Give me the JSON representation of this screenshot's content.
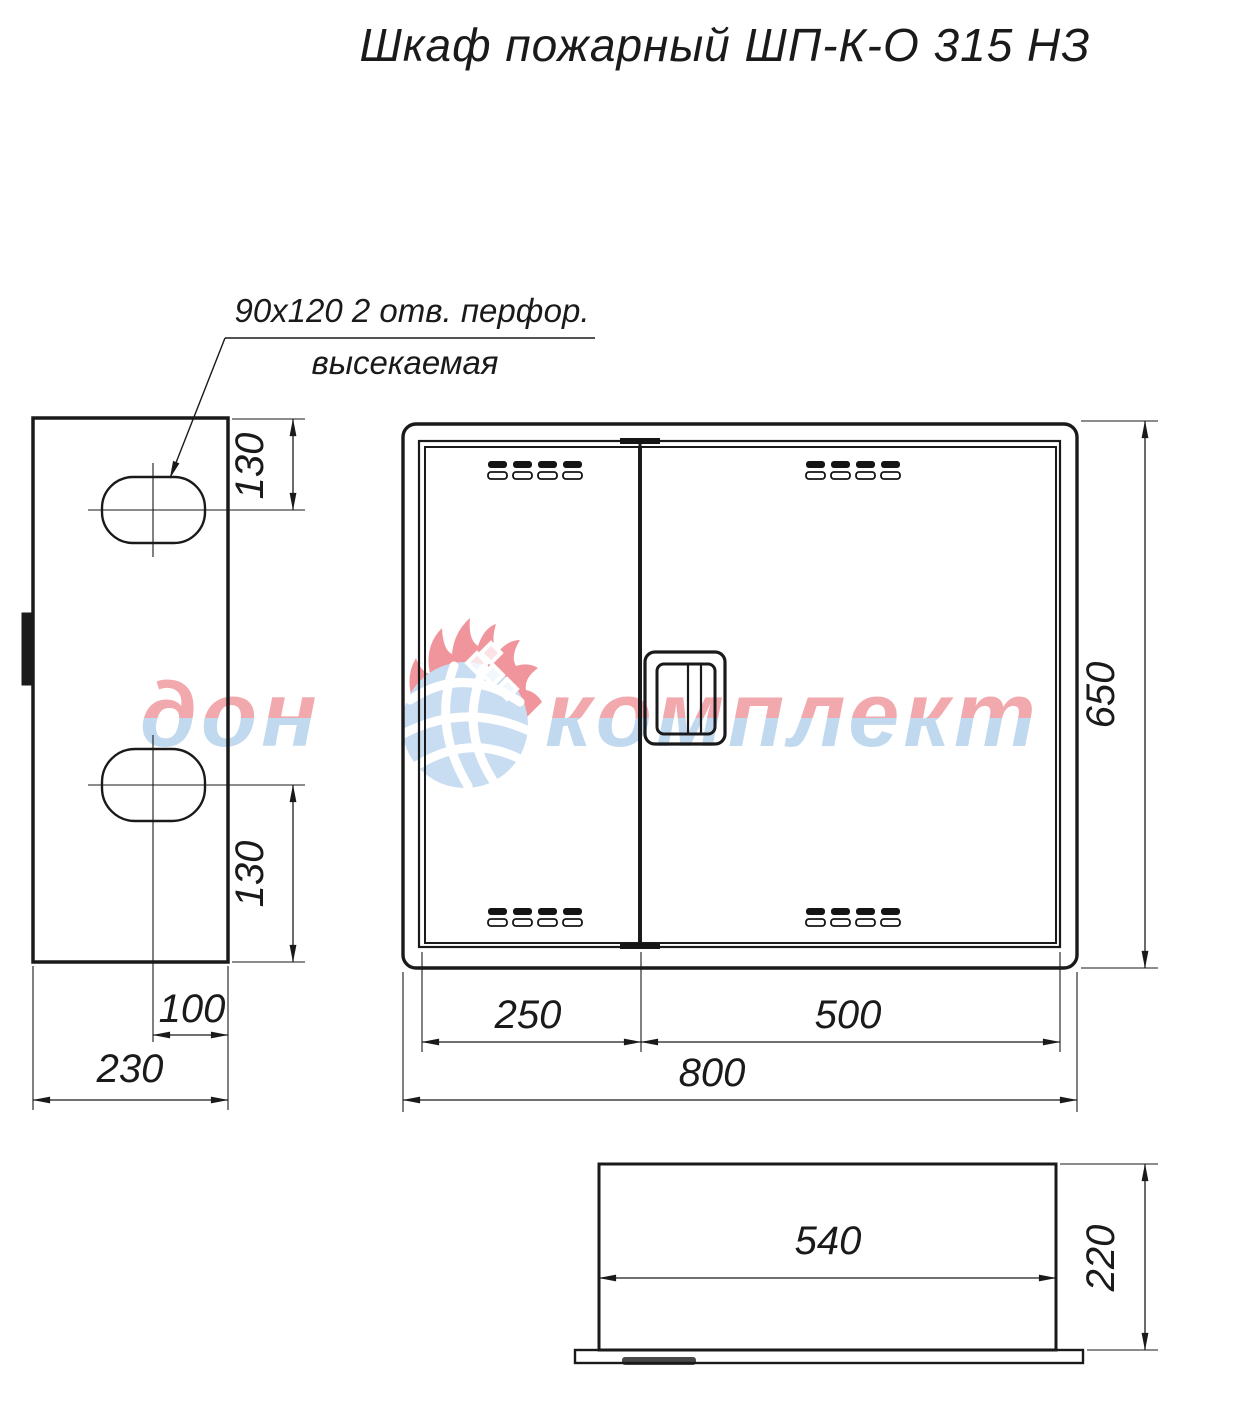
{
  "title": "Шкаф пожарный ШП-К-О 315 НЗ",
  "annotation": {
    "line1": "90x120  2 отв. перфор.",
    "line2": "высекаемая"
  },
  "side_view": {
    "dim_hole_top": "130",
    "dim_hole_bottom": "130",
    "dim_hole_center": "100",
    "dim_depth": "230"
  },
  "front_view": {
    "dim_left_door": "250",
    "dim_right_door": "500",
    "dim_width": "800",
    "dim_height": "650"
  },
  "bottom_view": {
    "dim_inner_width": "540",
    "dim_depth": "220"
  },
  "watermark": {
    "word1": "дон",
    "word2": "комплект",
    "color_top": "#f2a5aa",
    "color_bottom": "#bed8ef",
    "flame_color": "#f1959c",
    "ball_color": "#c8ddf1"
  },
  "colors": {
    "line": "#1a1a1a",
    "background": "#ffffff"
  }
}
